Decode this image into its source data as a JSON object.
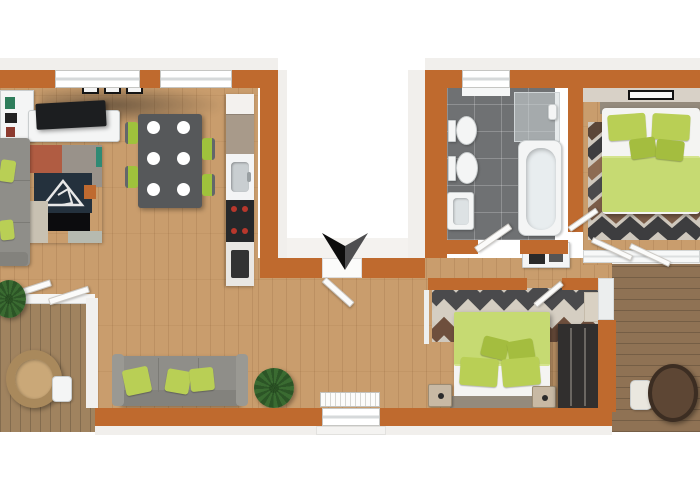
{
  "meta": {
    "type": "floor-plan-3d-render",
    "description": "Top-down 3D rendered floor plan of an apartment wrapped around a central exterior notch, with an entrance direction marker"
  },
  "palette": {
    "wall": "#bf6a2e",
    "wood": "#c99d6d",
    "deck-left": "#a0835f",
    "deck-right": "#8f7254",
    "tile": "#6f7173",
    "fixture": "#f4f5f5",
    "lime": "#b9cf55",
    "lime-dark": "#a4bd3f",
    "duvet": "#c6da72",
    "sofa": "#8f8e89",
    "sofa-dark": "#83827d",
    "table": "#56585a",
    "chair": "#9fc23c",
    "rug-navy": "#24313d",
    "rug-rust": "#b05c42",
    "wardrobe": "#312f2e",
    "plant": "#3a6b31",
    "wicker": "#a9895c",
    "headboard": "#948a7c",
    "nightstand": "#c8b9a4",
    "arrow-dark": "#0c0c0c",
    "arrow-gray": "#4e4e50",
    "tv": "#1c1e20",
    "stove": "#26282a"
  },
  "rooms": [
    {
      "id": "living-kitchen",
      "name": "Open living / dining / kitchen (left wing)"
    },
    {
      "id": "lounge",
      "name": "Lounge area (bottom band)"
    },
    {
      "id": "hallway",
      "name": "Entrance hallway and corridor"
    },
    {
      "id": "bathroom",
      "name": "Bathroom"
    },
    {
      "id": "bedroom-top",
      "name": "Bedroom (top right)"
    },
    {
      "id": "bedroom-bottom",
      "name": "Bedroom (bottom right)"
    },
    {
      "id": "balcony-left",
      "name": "Balcony with wicker chair (bottom left)"
    },
    {
      "id": "balcony-right",
      "name": "Balcony with round table (bottom right)"
    }
  ],
  "furniture": [
    "tv",
    "tv-console",
    "shelf-unit",
    "wall-frames",
    "corner-sofa",
    "patch-area-rug",
    "dining-table",
    "dining-plates",
    "dining-chairs",
    "kitchen-counter",
    "kitchen-sink",
    "stove",
    "oven",
    "window",
    "entrance-door",
    "entrance-arrow-marker",
    "bidet",
    "toilet",
    "washbasin",
    "bathtub",
    "shower-glass",
    "laundry-cabinet",
    "double-bed-green",
    "chevron-rug",
    "wardrobe",
    "nightstand",
    "picture-frame",
    "sofa-green-pillows",
    "potted-plant",
    "radiator",
    "doormat",
    "wicker-chair",
    "balcony-side-table",
    "balcony-round-table",
    "balcony-stool",
    "sliding-glass-door"
  ]
}
